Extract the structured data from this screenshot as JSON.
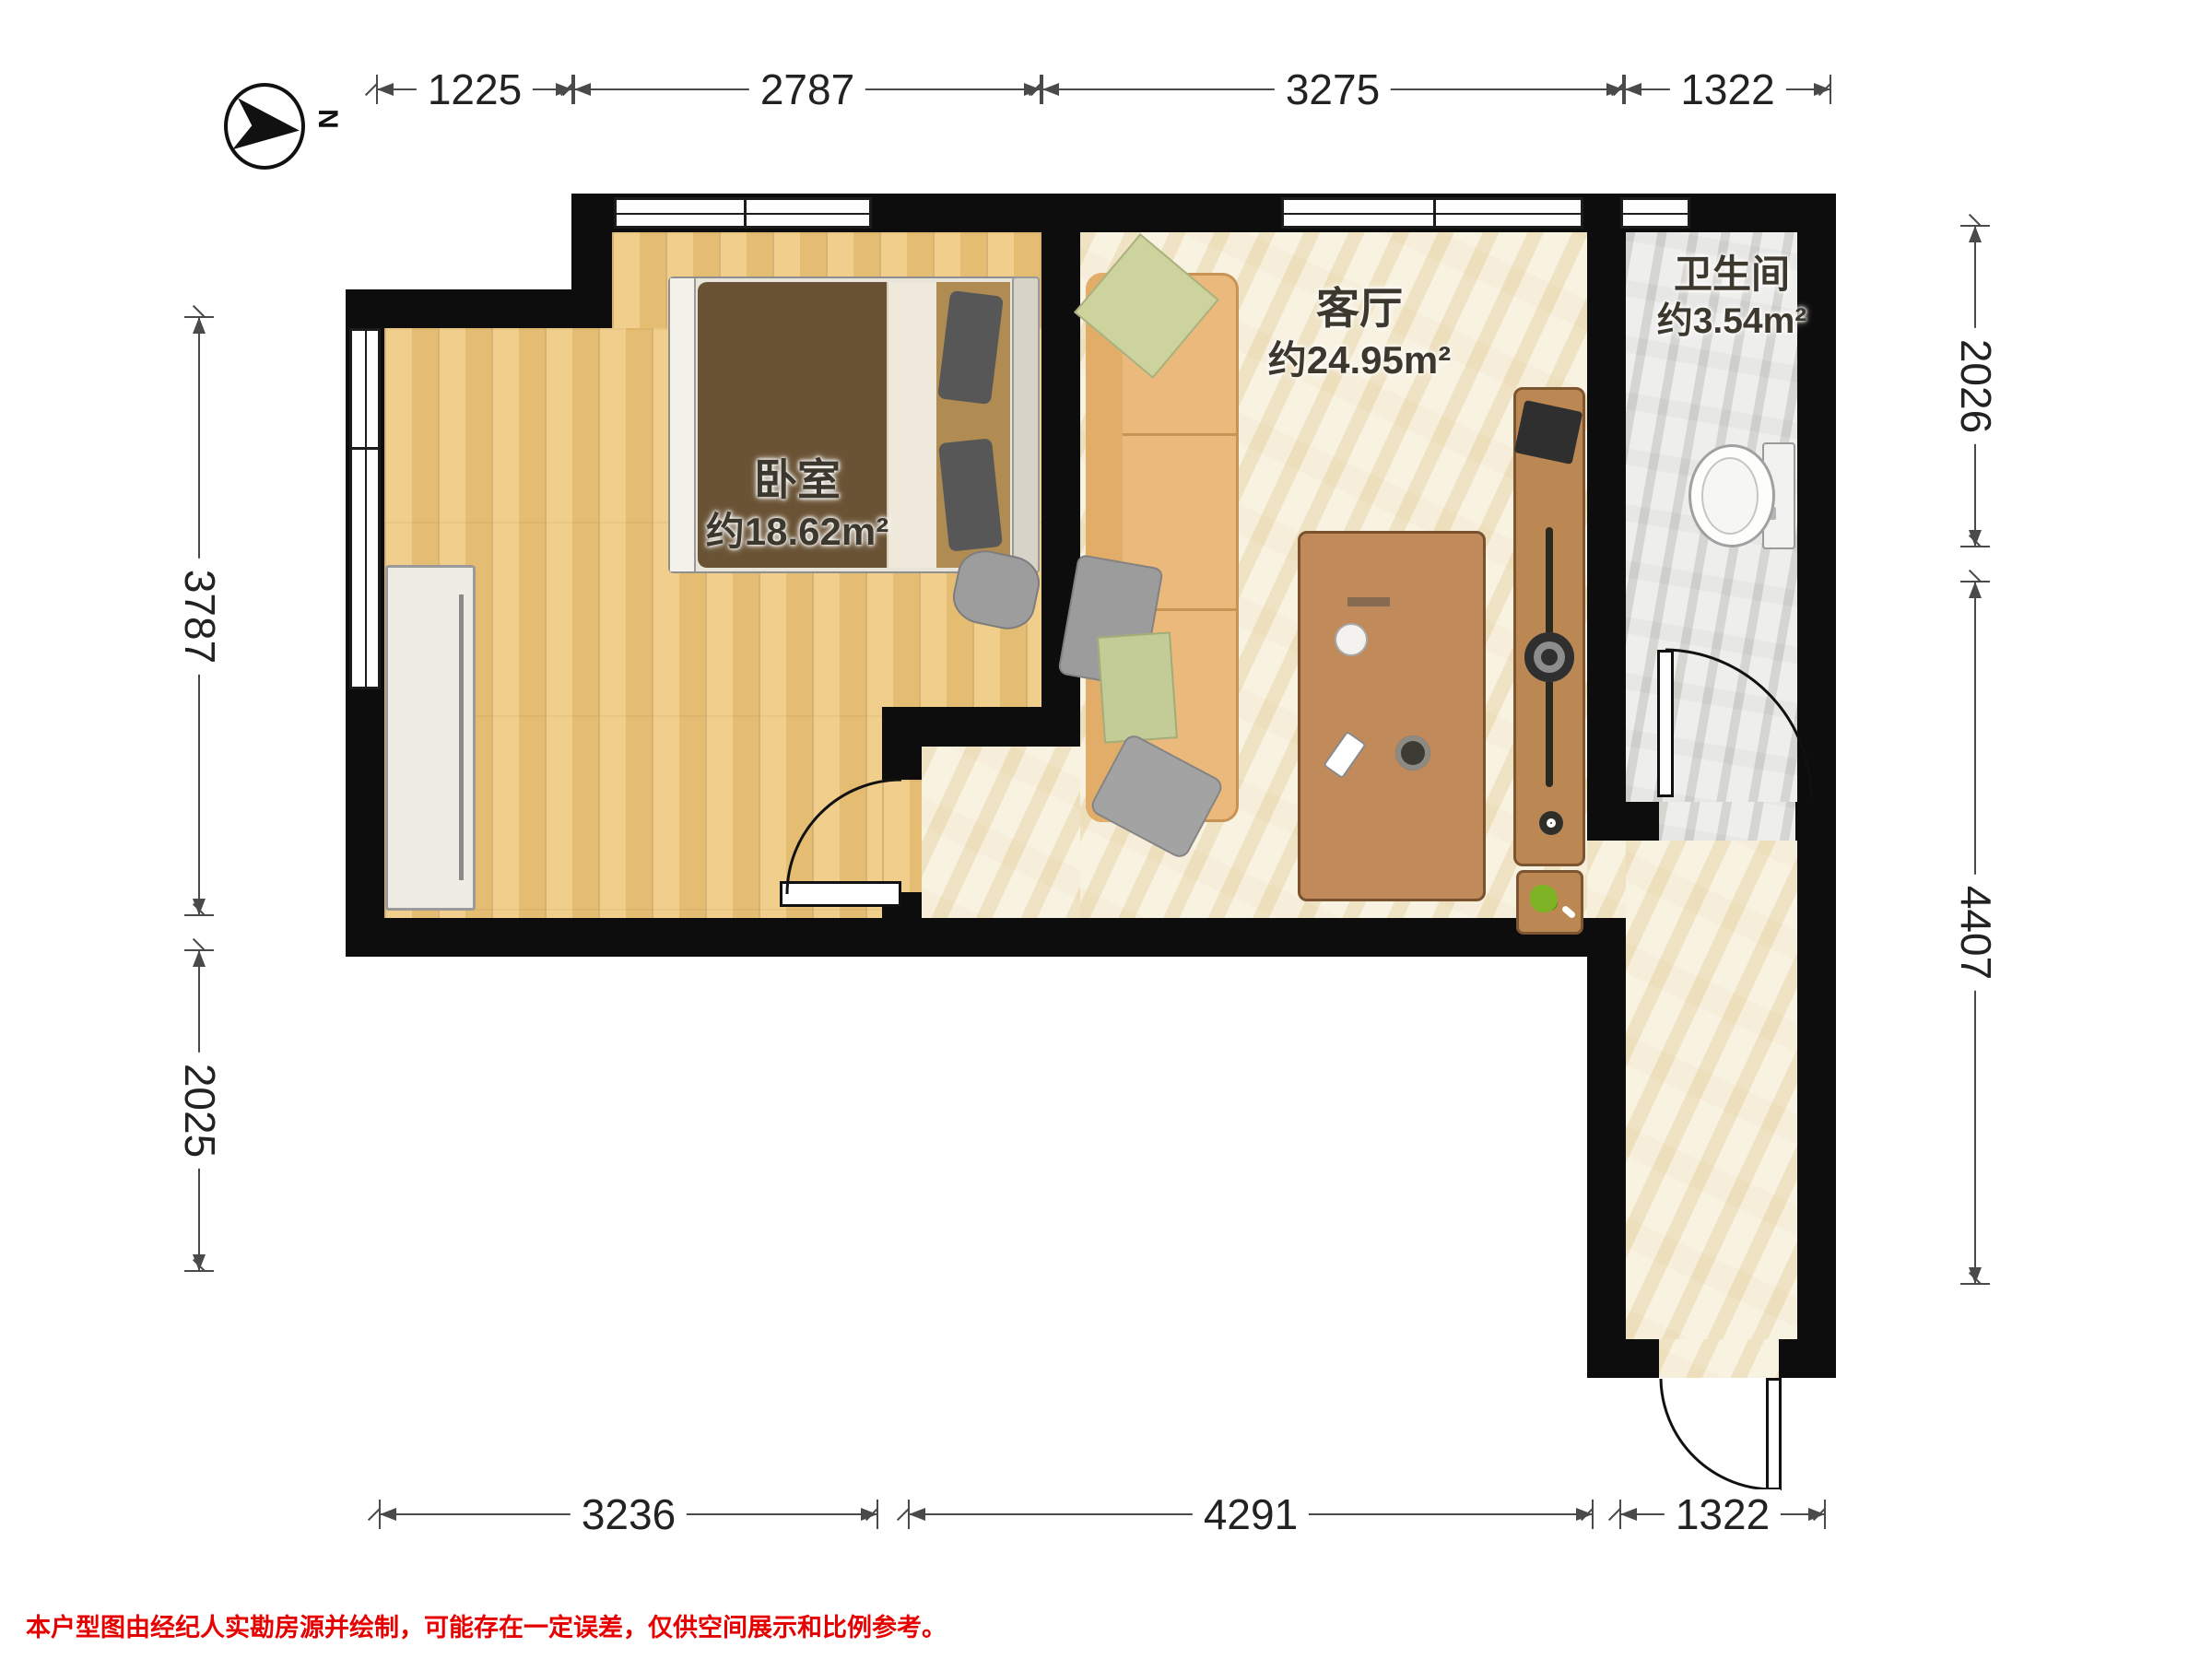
{
  "compass": {
    "label": "N"
  },
  "rooms": [
    {
      "id": "bedroom",
      "name": "卧室",
      "area": "约18.62m²"
    },
    {
      "id": "living",
      "name": "客厅",
      "area": "约24.95m²"
    },
    {
      "id": "bathroom",
      "name": "卫生间",
      "area": "约3.54m²"
    }
  ],
  "dimensions": {
    "top": [
      "1225",
      "2787",
      "3275",
      "1322"
    ],
    "left": [
      "3787",
      "2025"
    ],
    "right": [
      "2026",
      "4407"
    ],
    "bottom": [
      "3236",
      "4291",
      "1322"
    ]
  },
  "disclaimer": "本户型图由经纪人实勘房源并绘制，可能存在一定误差，仅供空间展示和比例参考。",
  "colors": {
    "wall": "#0d0d0d",
    "wood_floor": "#efc97e",
    "marble_floor": "#f6eed7",
    "tile_floor": "#e7e7e4",
    "furniture_wood": "#bb8752",
    "sofa": "#eab97b",
    "bed_duvet": "#6a5335",
    "dimension_line": "#4a4a4a",
    "disclaimer_text": "#e60000"
  }
}
